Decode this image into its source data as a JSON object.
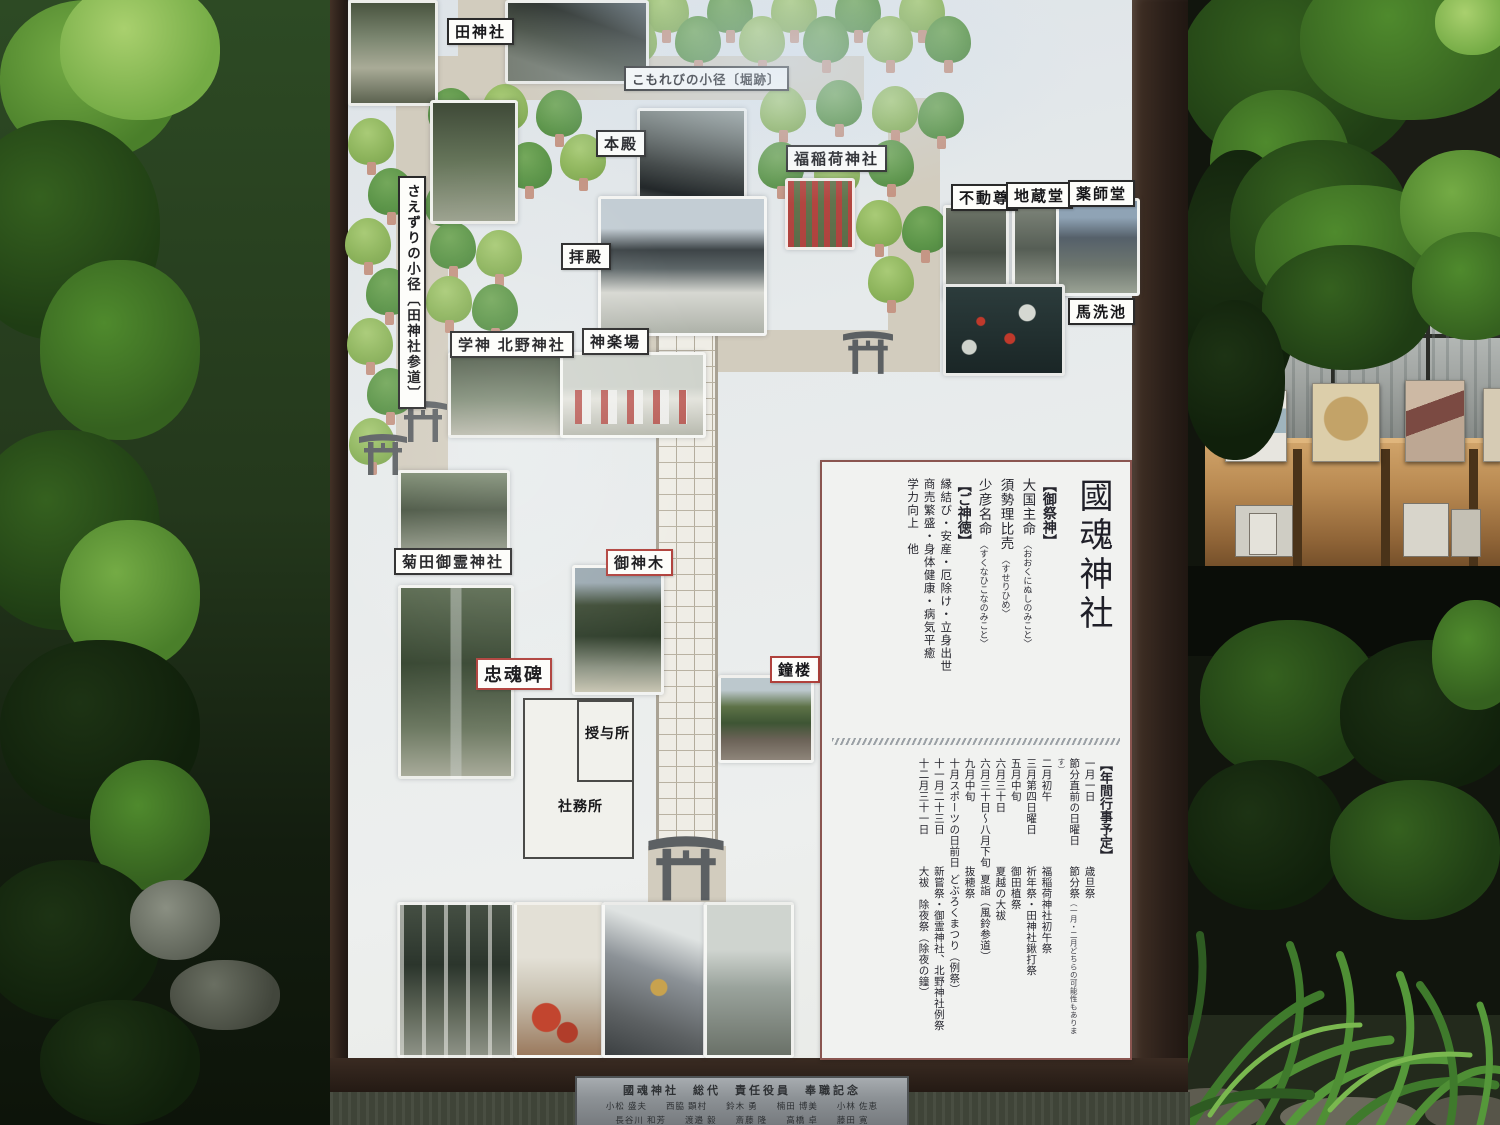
{
  "board": {
    "map": {
      "labels": {
        "ta_jinja": "田神社",
        "komorebi": "こもれびの小径〔堀跡〕",
        "honden": "本殿",
        "haiden": "拝殿",
        "fuku_inari": "福稲荷神社",
        "fudoson": "不動尊",
        "jizodo": "地蔵堂",
        "yakushido": "薬師堂",
        "umaarai_ike": "馬洗池",
        "saezuri": "さえずりの小径〔田神社参道〕",
        "gakushin_kitano": "学神 北野神社",
        "kaguraba": "神楽場",
        "kikuta_goryo": "菊田御霊神社",
        "goshinboku": "御神木",
        "chukonhi": "忠魂碑",
        "shoro": "鐘楼",
        "juyosho": "授与所",
        "shamusho": "社務所"
      }
    },
    "panel": {
      "title": "國魂神社",
      "gosaijin": {
        "heading": "【御祭神】",
        "deities": [
          {
            "name": "大国主命",
            "kana": "〈おおくにぬしのみこと〉"
          },
          {
            "name": "須勢理比売",
            "kana": "〈すせりひめ〉"
          },
          {
            "name": "少彦名命",
            "kana": "〈すくなひこなのみこと〉"
          }
        ]
      },
      "goshintoku": {
        "heading": "【ご神徳】",
        "items": [
          "縁結び・安産・厄除け・立身出世",
          "商売繁盛・身体健康・病気平癒",
          "学力向上　他"
        ]
      },
      "gyoji": {
        "heading": "【年間行事予定】",
        "entries": [
          {
            "date": "一月一日",
            "event": "歳旦祭"
          },
          {
            "date": "節分直前の日曜日",
            "event": "節分祭",
            "note": "（一月・二月どちらの可能性もあります）"
          },
          {
            "date": "二月初午",
            "event": "福稲荷神社初午祭"
          },
          {
            "date": "三月第四日曜日",
            "event": "祈年祭・田神社鍬打祭"
          },
          {
            "date": "五月中旬",
            "event": "御田植祭"
          },
          {
            "date": "六月三十日",
            "event": "夏越の大祓"
          },
          {
            "date": "六月三十日～八月下旬",
            "event": "夏詣（風鈴参道）"
          },
          {
            "date": "九月中旬",
            "event": "抜穂祭"
          },
          {
            "date": "十月スポーツの日前日",
            "event": "どぶろくまつり（例祭）"
          },
          {
            "date": "十一月二十三日",
            "event": "新嘗祭・御霊神社、北野神社例祭"
          },
          {
            "date": "十二月三十一日",
            "event": "大祓　除夜祭（除夜の鐘）"
          }
        ]
      }
    },
    "plaque": {
      "title": "國魂神社　総代　責任役員　奉職記念",
      "names_row1": "小松 盛夫　　西脇 顕村　　鈴木 勇　　楠田 博美　　小林 佐恵",
      "names_row2": "長谷川 和芳　　渡邉 毅　　斎藤 隆　　高橋 卓　　藤田 寛"
    }
  },
  "colors": {
    "board_frame": "#32251e",
    "map_surface": "#e7ebec",
    "path_gray": "#d2ccbe",
    "brick_light": "#efede6",
    "tree_light": "#8db45c",
    "tree_dark": "#5c9549",
    "label_border": "#2a2a2a",
    "label_border_red": "#b0413c",
    "panel_border": "#8a5550",
    "torii_gray": "#5c6063"
  },
  "icons": [
    "torii-gate-icon",
    "tree-icon"
  ]
}
